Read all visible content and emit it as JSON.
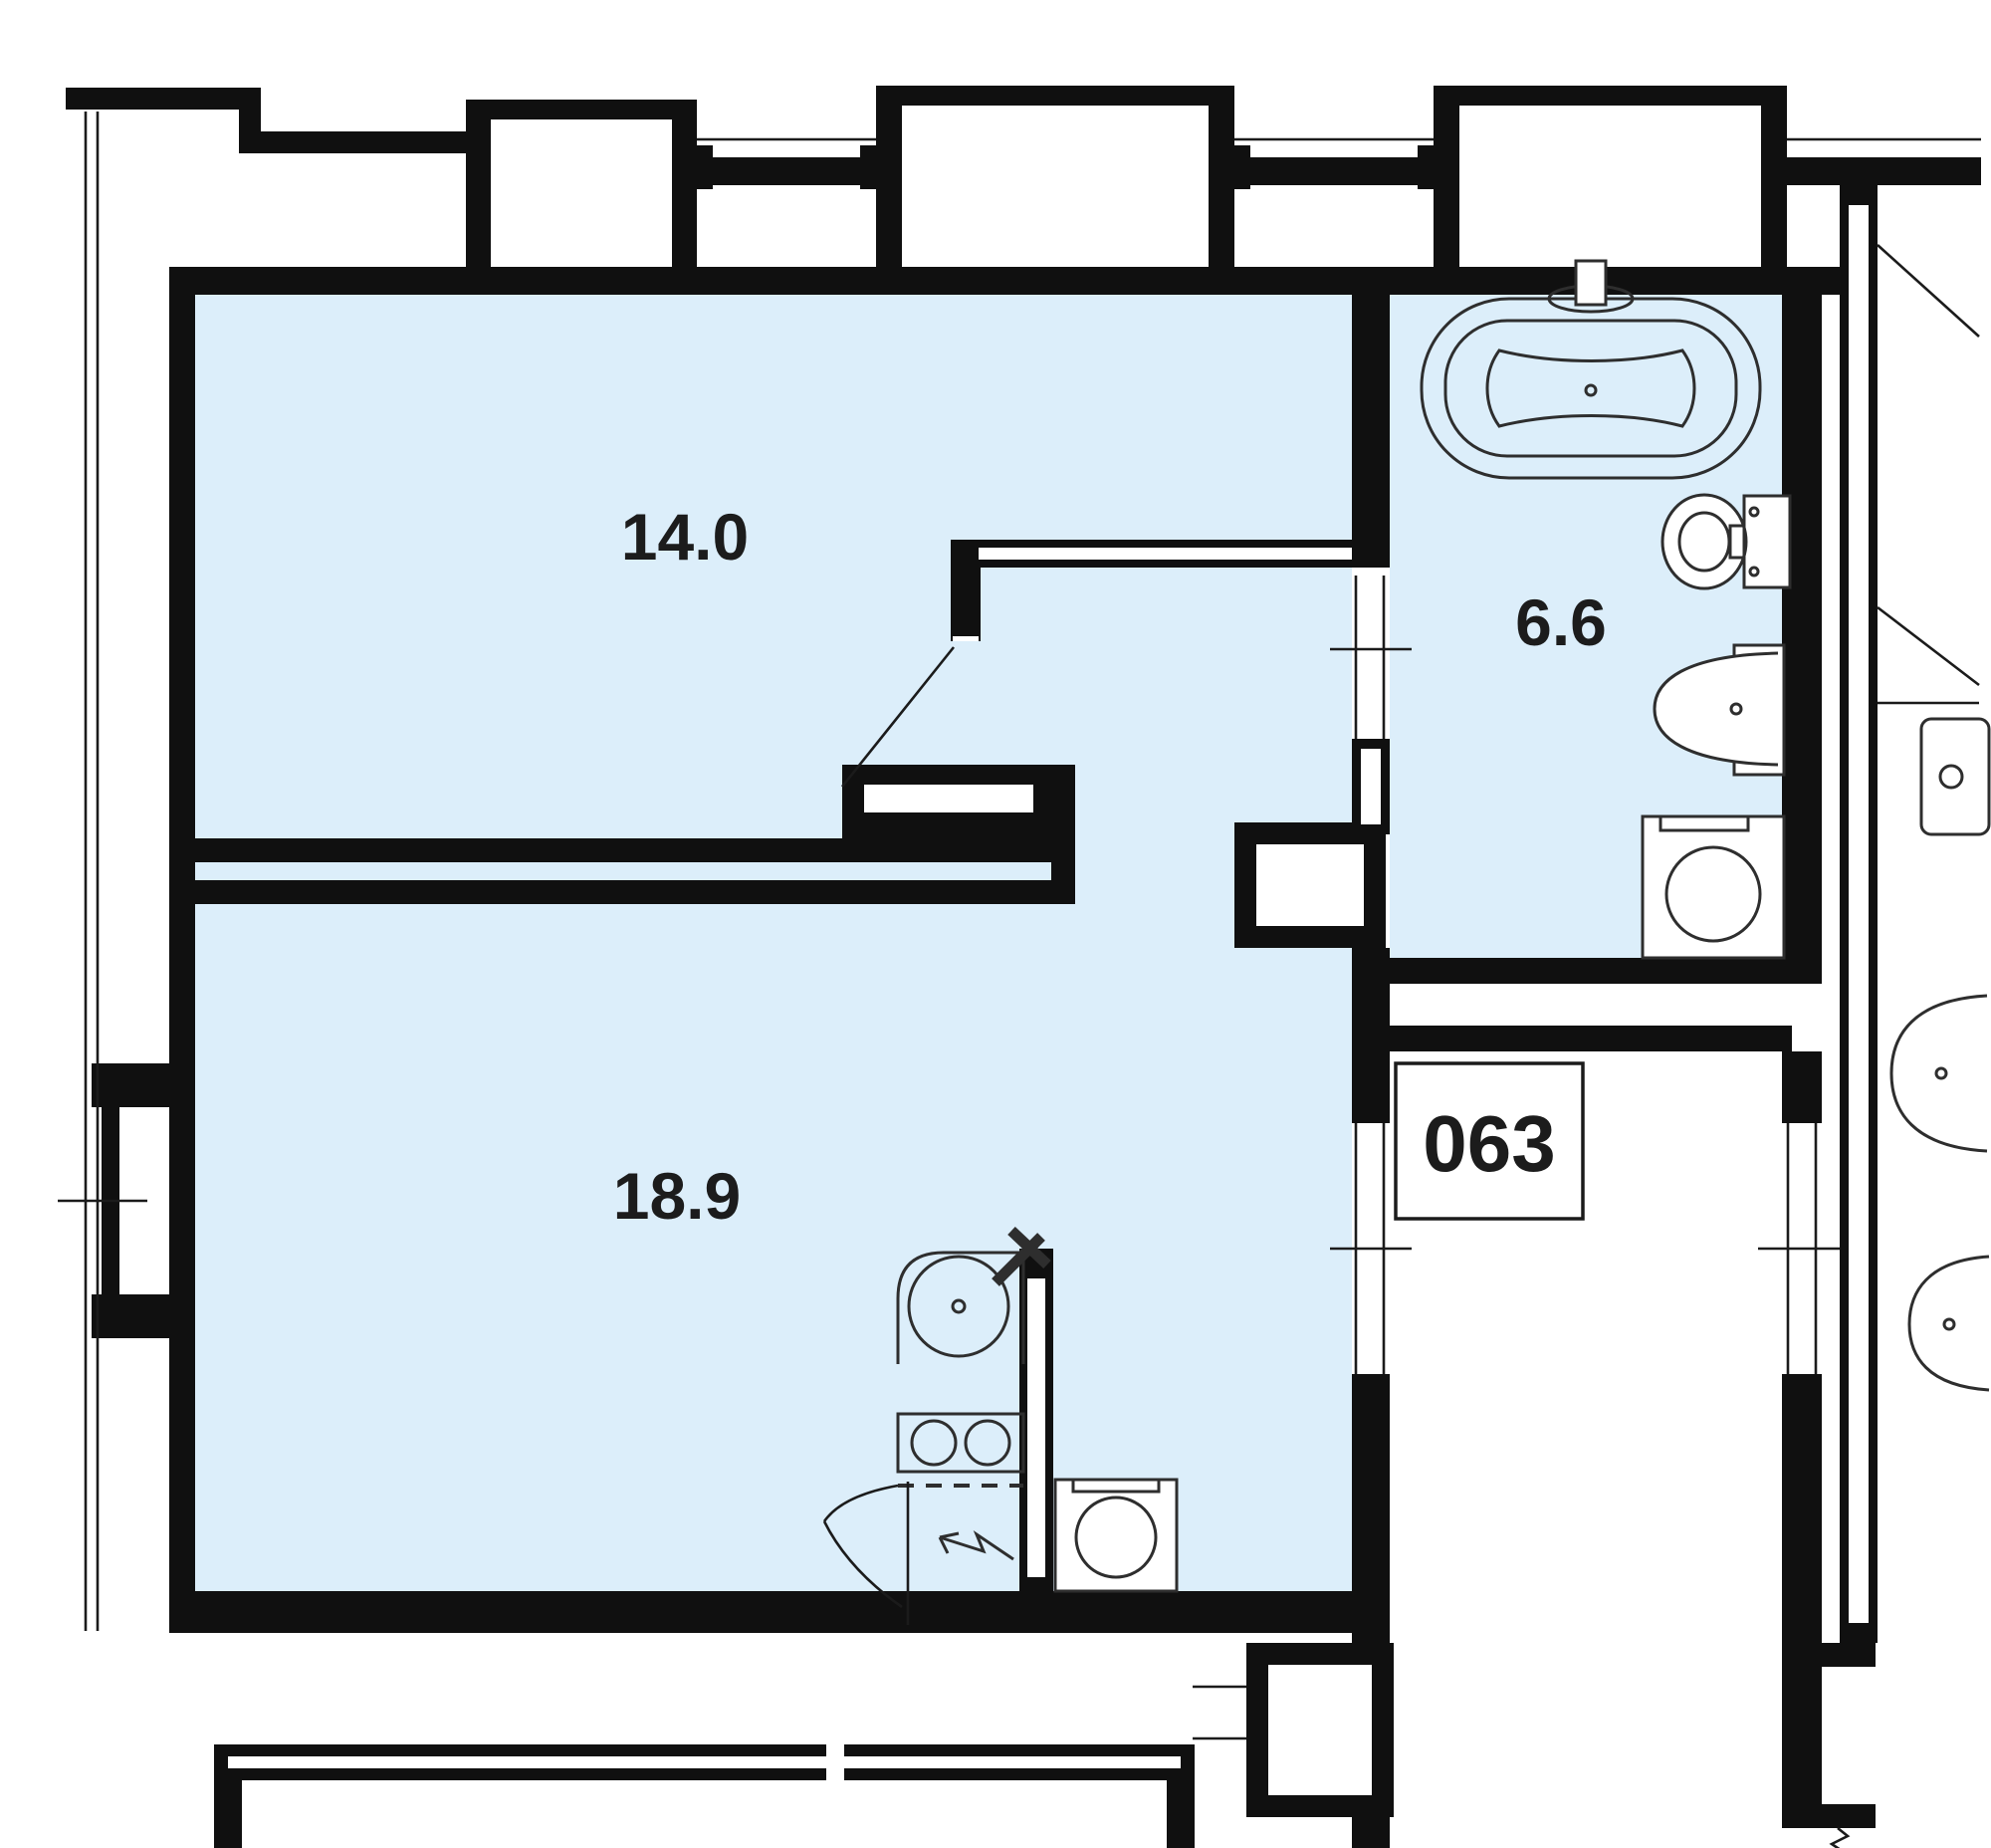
{
  "floor_plan": {
    "unit_number_label": "063",
    "rooms": [
      {
        "id": "room-top",
        "area_label": "14.0"
      },
      {
        "id": "room-bottom",
        "area_label": "18.9"
      },
      {
        "id": "bathroom",
        "area_label": "6.6"
      }
    ],
    "fixtures": [
      "bathtub-icon",
      "bath-faucet-icon",
      "toilet-icon",
      "washbasin-icon",
      "washing-machine-icon",
      "kitchen-sink-icon",
      "sink-faucet-icon",
      "stove-2-burner-icon",
      "appliance-icon",
      "electric-arrow-icon",
      "door-swing-icon",
      "balcony-door-swing-icon",
      "window-icon",
      "duct-shaft-icon",
      "neighbor-toilet-icon",
      "neighbor-basin-icon"
    ],
    "colors": {
      "background": "#ffffff",
      "room_fill": "#dceefa",
      "wall": "#101010",
      "fixture_stroke": "#2e2e2e",
      "label_text": "#1c1c1c"
    }
  }
}
